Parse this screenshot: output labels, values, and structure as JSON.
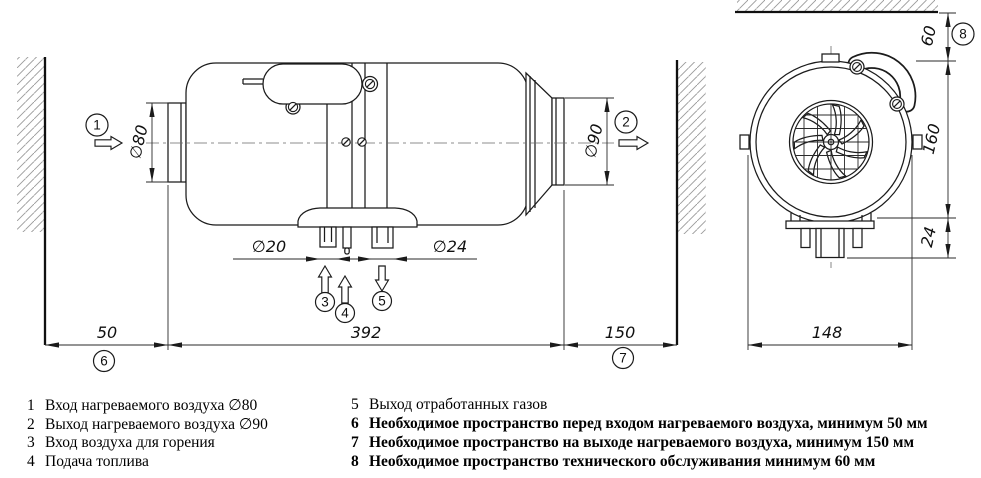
{
  "drawing": {
    "dims": {
      "d80": "∅80",
      "d90": "∅90",
      "d20": "∅20",
      "d24": "∅24",
      "front_space": "50",
      "body_length": "392",
      "outlet_space": "150",
      "front_width": "148",
      "top_space": "60",
      "body_height": "160",
      "pipe_stub": "24"
    },
    "callouts": {
      "c1": "1",
      "c2": "2",
      "c3": "3",
      "c4": "4",
      "c5": "5",
      "c6": "6",
      "c7": "7",
      "c8": "8"
    }
  },
  "legend": {
    "left": [
      {
        "num": "1",
        "text": "Вход нагреваемого воздуха ∅80"
      },
      {
        "num": "2",
        "text": "Выход нагреваемого воздуха ∅90"
      },
      {
        "num": "3",
        "text": "Вход воздуха для горения"
      },
      {
        "num": "4",
        "text": "Подача топлива"
      }
    ],
    "right": [
      {
        "num": "5",
        "text": "Выход отработанных газов"
      },
      {
        "num": "6",
        "text": "Необходимое пространство перед входом нагреваемого воздуха, минимум 50 мм"
      },
      {
        "num": "7",
        "text": "Необходимое пространство на выходе нагреваемого воздуха, минимум 150 мм"
      },
      {
        "num": "8",
        "text": "Необходимое пространство технического обслуживания минимум 60 мм"
      }
    ]
  }
}
